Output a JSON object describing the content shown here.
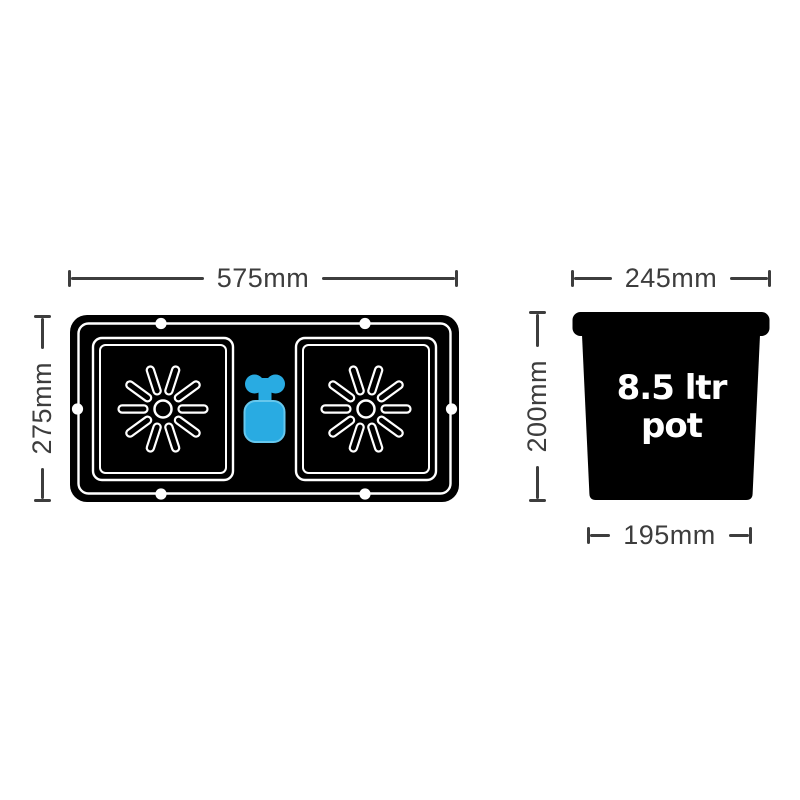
{
  "tray": {
    "width_label": "575mm",
    "height_label": "275mm"
  },
  "pot": {
    "top_width_label": "245mm",
    "height_label": "200mm",
    "bottom_width_label": "195mm",
    "volume_label_line1": "8.5 ltr",
    "volume_label_line2": "pot"
  },
  "colors": {
    "shape_black": "#000000",
    "outline_white": "#ffffff",
    "valve_blue": "#29ABE2",
    "valve_blue_highlight": "#66C7ED",
    "dimension_gray": "#3d3d3d",
    "background": "#ffffff"
  },
  "icons": {
    "root_disc": "starburst-icon",
    "valve": "aquavalve-icon",
    "peg_hole": "peg-hole-dot"
  }
}
